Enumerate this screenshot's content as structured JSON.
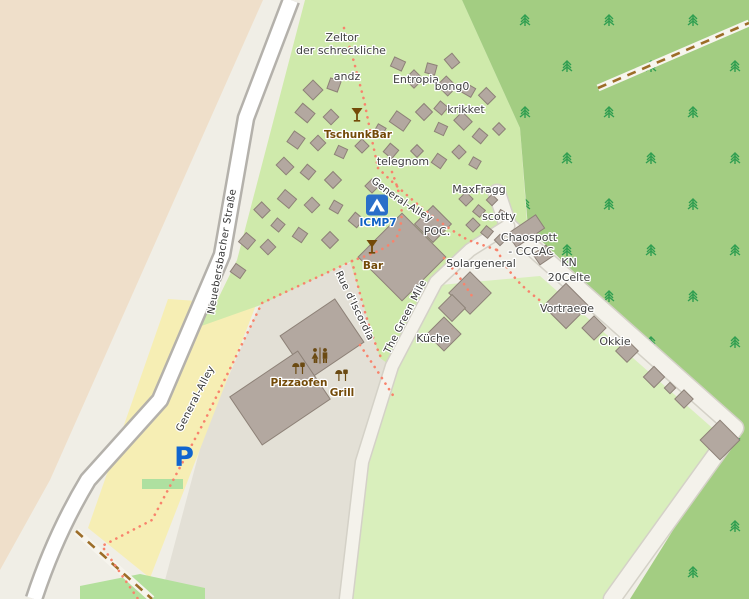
{
  "labels": {
    "zeltor_line1": "Zeltor",
    "zeltor_line2": "der schreckliche",
    "andz": "andz",
    "entropia": "Entropia",
    "bong0": "bong0",
    "krikket": "krikket",
    "tschunkbar": "TschunkBar",
    "telegnom": "telegnom",
    "general_alley_upper": "General-Alley",
    "maxfragg": "MaxFragg",
    "scotty": "scotty",
    "icmp7": "ICMP7",
    "poc": "POC.",
    "chaospott": "Chaospott",
    "cccac": "- CCCAC",
    "kn": "KN",
    "celte": "20Celte",
    "bar": "Bar",
    "solargeneral": "Solargeneral",
    "rue_discordia": "Rue d'Iscordia",
    "green_mile": "The Green Mile",
    "vortraege": "Vortraege",
    "kueche": "Küche",
    "okkie": "Okkie",
    "pizzaofen": "Pizzaofen",
    "grill": "Grill",
    "neuebersbacher": "Neuebersbacher Straße",
    "general_alley_lower": "General-Alley",
    "parking": "P"
  },
  "icons": {
    "icmp7": "campsite-tent",
    "tschunkbar": "cocktail-glass",
    "bar": "cocktail-glass",
    "toilets": "man-woman-toilets",
    "pizzaofen": "bbq-grill",
    "grill": "bbq-grill",
    "parking": "parking-p"
  },
  "colors": {
    "farmland": "#efdfca",
    "base": "#f0eee6",
    "pedestrian": "#e3e0d6",
    "grass": "#cfeaab",
    "field": "#d9efbc",
    "forest": "#a3cd82",
    "tree": "#2f9e50",
    "building": "#b3a8a0",
    "building_outline": "#8d8177",
    "road_fill": "#ffffff",
    "road_casing": "#b4b1ab",
    "minor_road": "#f4f2eb",
    "minor_casing": "#d4d1c7",
    "parking": "#f6eeb4",
    "parking_symbol": "#1065cf",
    "footpath_dots": "#f8836c",
    "track_dashes": "#9c6d28",
    "label_dark": "#3f3f3f",
    "label_poi": "#734a08",
    "label_blue": "#0f62c5",
    "grass_patch": "#b3e09c"
  },
  "buildings": [
    [
      313,
      90,
      14,
      14,
      45
    ],
    [
      334,
      85,
      11,
      11,
      20
    ],
    [
      305,
      113,
      16,
      12,
      40
    ],
    [
      331,
      117,
      11,
      11,
      45
    ],
    [
      296,
      140,
      13,
      13,
      35
    ],
    [
      318,
      143,
      11,
      11,
      45
    ],
    [
      341,
      152,
      10,
      10,
      25
    ],
    [
      285,
      166,
      14,
      11,
      45
    ],
    [
      308,
      172,
      11,
      11,
      40
    ],
    [
      333,
      180,
      12,
      12,
      45
    ],
    [
      287,
      199,
      15,
      12,
      40
    ],
    [
      312,
      205,
      11,
      11,
      45
    ],
    [
      336,
      207,
      10,
      10,
      30
    ],
    [
      247,
      241,
      12,
      12,
      40
    ],
    [
      268,
      247,
      11,
      11,
      45
    ],
    [
      238,
      271,
      12,
      10,
      35
    ],
    [
      362,
      146,
      10,
      10,
      45
    ],
    [
      380,
      130,
      9,
      9,
      30
    ],
    [
      372,
      186,
      10,
      10,
      45
    ],
    [
      356,
      220,
      11,
      11,
      40
    ],
    [
      330,
      240,
      12,
      12,
      45
    ],
    [
      300,
      235,
      11,
      11,
      35
    ],
    [
      262,
      210,
      12,
      11,
      45
    ],
    [
      278,
      225,
      10,
      10,
      40
    ],
    [
      398,
      64,
      12,
      10,
      25
    ],
    [
      414,
      79,
      13,
      13,
      45
    ],
    [
      431,
      69,
      10,
      10,
      15
    ],
    [
      452,
      61,
      12,
      10,
      50
    ],
    [
      447,
      86,
      15,
      13,
      45
    ],
    [
      468,
      90,
      12,
      10,
      30
    ],
    [
      487,
      96,
      13,
      11,
      45
    ],
    [
      441,
      108,
      10,
      10,
      40
    ],
    [
      400,
      121,
      17,
      13,
      35
    ],
    [
      424,
      112,
      12,
      12,
      45
    ],
    [
      441,
      129,
      10,
      10,
      25
    ],
    [
      463,
      121,
      14,
      12,
      45
    ],
    [
      480,
      136,
      11,
      11,
      40
    ],
    [
      499,
      129,
      9,
      9,
      45
    ],
    [
      391,
      151,
      11,
      11,
      40
    ],
    [
      417,
      151,
      9,
      9,
      45
    ],
    [
      439,
      161,
      11,
      11,
      35
    ],
    [
      459,
      152,
      10,
      10,
      45
    ],
    [
      475,
      163,
      9,
      9,
      30
    ],
    [
      466,
      199,
      10,
      10,
      45
    ],
    [
      479,
      211,
      9,
      9,
      40
    ],
    [
      492,
      200,
      8,
      8,
      45
    ],
    [
      502,
      215,
      8,
      8,
      30
    ],
    [
      473,
      225,
      10,
      10,
      45
    ],
    [
      487,
      232,
      9,
      9,
      40
    ],
    [
      500,
      240,
      8,
      8,
      45
    ],
    [
      433,
      224,
      26,
      26,
      45
    ],
    [
      402,
      257,
      62,
      62,
      45
    ],
    [
      526,
      231,
      34,
      16,
      -34
    ],
    [
      543,
      255,
      16,
      13,
      -34
    ],
    [
      470,
      293,
      30,
      30,
      45
    ],
    [
      444,
      334,
      24,
      24,
      45
    ],
    [
      452,
      308,
      19,
      19,
      45
    ],
    [
      566,
      306,
      32,
      32,
      45
    ],
    [
      594,
      328,
      17,
      17,
      45
    ],
    [
      627,
      351,
      16,
      16,
      45
    ],
    [
      654,
      377,
      15,
      15,
      45
    ],
    [
      670,
      388,
      8,
      8,
      45
    ],
    [
      684,
      399,
      13,
      13,
      45
    ],
    [
      720,
      440,
      28,
      28,
      45
    ],
    [
      322,
      339,
      66,
      52,
      -34
    ],
    [
      280,
      398,
      82,
      58,
      -34
    ]
  ]
}
